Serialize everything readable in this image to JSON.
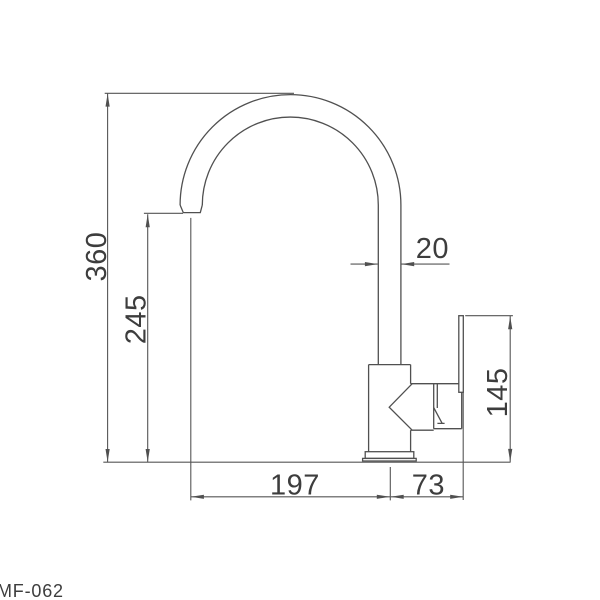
{
  "drawing": {
    "model": "MF-062",
    "dimensions": {
      "total_height": "360",
      "spout_outlet_height": "245",
      "spout_pipe_width": "20",
      "handle_top_height": "145",
      "spout_reach": "197",
      "handle_offset": "73"
    },
    "colors": {
      "line": "#505050",
      "text": "#3d3d3d",
      "background": "#ffffff"
    }
  }
}
